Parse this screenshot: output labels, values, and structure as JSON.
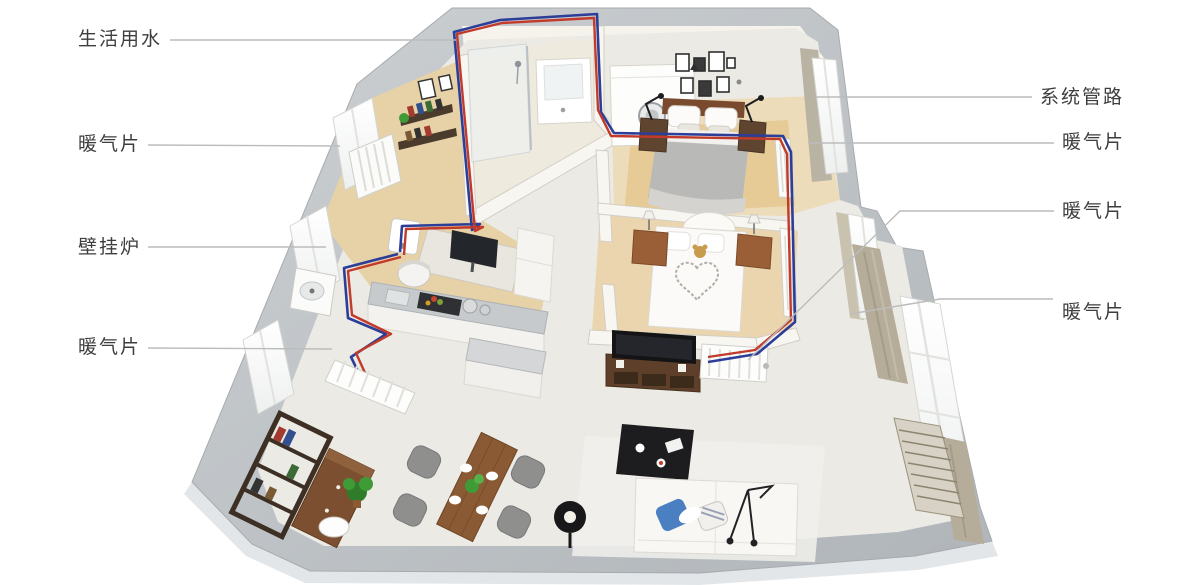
{
  "figure": {
    "type": "isometric-apartment-heating-floorplan",
    "background": "#ffffff",
    "colors": {
      "hot_pipe": "#c23a2a",
      "cold_pipe": "#2c3e97",
      "leader_line": "#bcbcbc",
      "label_text": "#3d3d3d",
      "outer_wall": "#bfc3c6",
      "wood_floor": "#e7d2a8",
      "tile_floor": "#eceae4"
    },
    "labels_left": [
      {
        "id": "domestic-water",
        "text": "生活用水"
      },
      {
        "id": "radiator-study",
        "text": "暖气片"
      },
      {
        "id": "wall-boiler",
        "text": "壁挂炉"
      },
      {
        "id": "radiator-kitchen",
        "text": "暖气片"
      }
    ],
    "labels_right": [
      {
        "id": "system-piping",
        "text": "系统管路"
      },
      {
        "id": "radiator-master-bedroom",
        "text": "暖气片"
      },
      {
        "id": "radiator-living-tv",
        "text": "暖气片"
      },
      {
        "id": "radiator-living-window",
        "text": "暖气片"
      }
    ]
  }
}
